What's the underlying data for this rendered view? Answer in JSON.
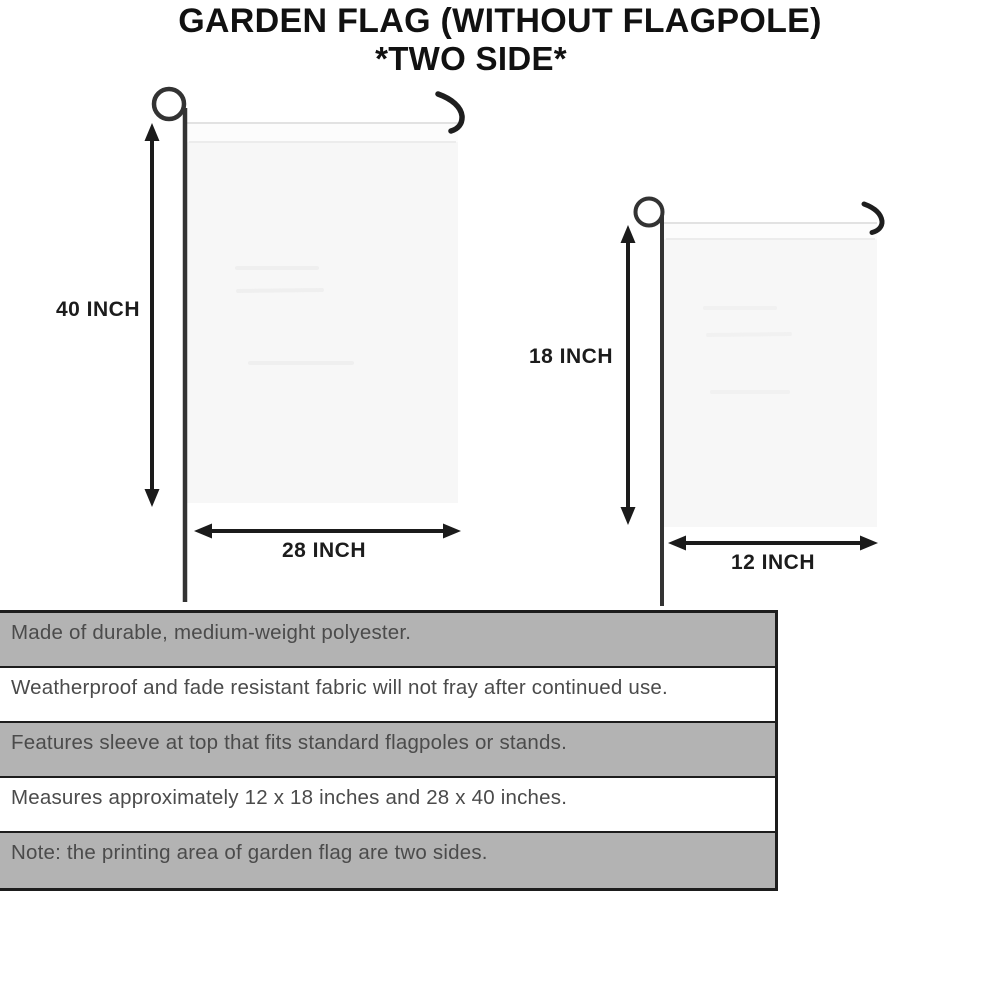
{
  "title": {
    "line1": "GARDEN FLAG (WITHOUT FLAGPOLE)",
    "line2": "*TWO SIDE*"
  },
  "diagrams": {
    "large_flag": {
      "height_label": "40 INCH",
      "width_label": "28 INCH"
    },
    "small_flag": {
      "height_label": "18 INCH",
      "width_label": "12 INCH"
    }
  },
  "spec_rows": [
    {
      "text": "Made of durable, medium-weight polyester."
    },
    {
      "text": "Weatherproof and fade resistant fabric will not fray after continued use."
    },
    {
      "text": "Features sleeve at top that fits standard flagpoles or stands."
    },
    {
      "text": "Measures approximately 12 x 18 inches and 28 x 40 inches."
    },
    {
      "text": "Note: the printing area of garden flag are two sides."
    }
  ],
  "colors": {
    "table_row_gray": "#b3b3b3",
    "table_border": "#1d1d1d",
    "table_text": "#4b4b4b",
    "ink": "#1c1c1c",
    "flag_fill": "#f7f7f7"
  }
}
